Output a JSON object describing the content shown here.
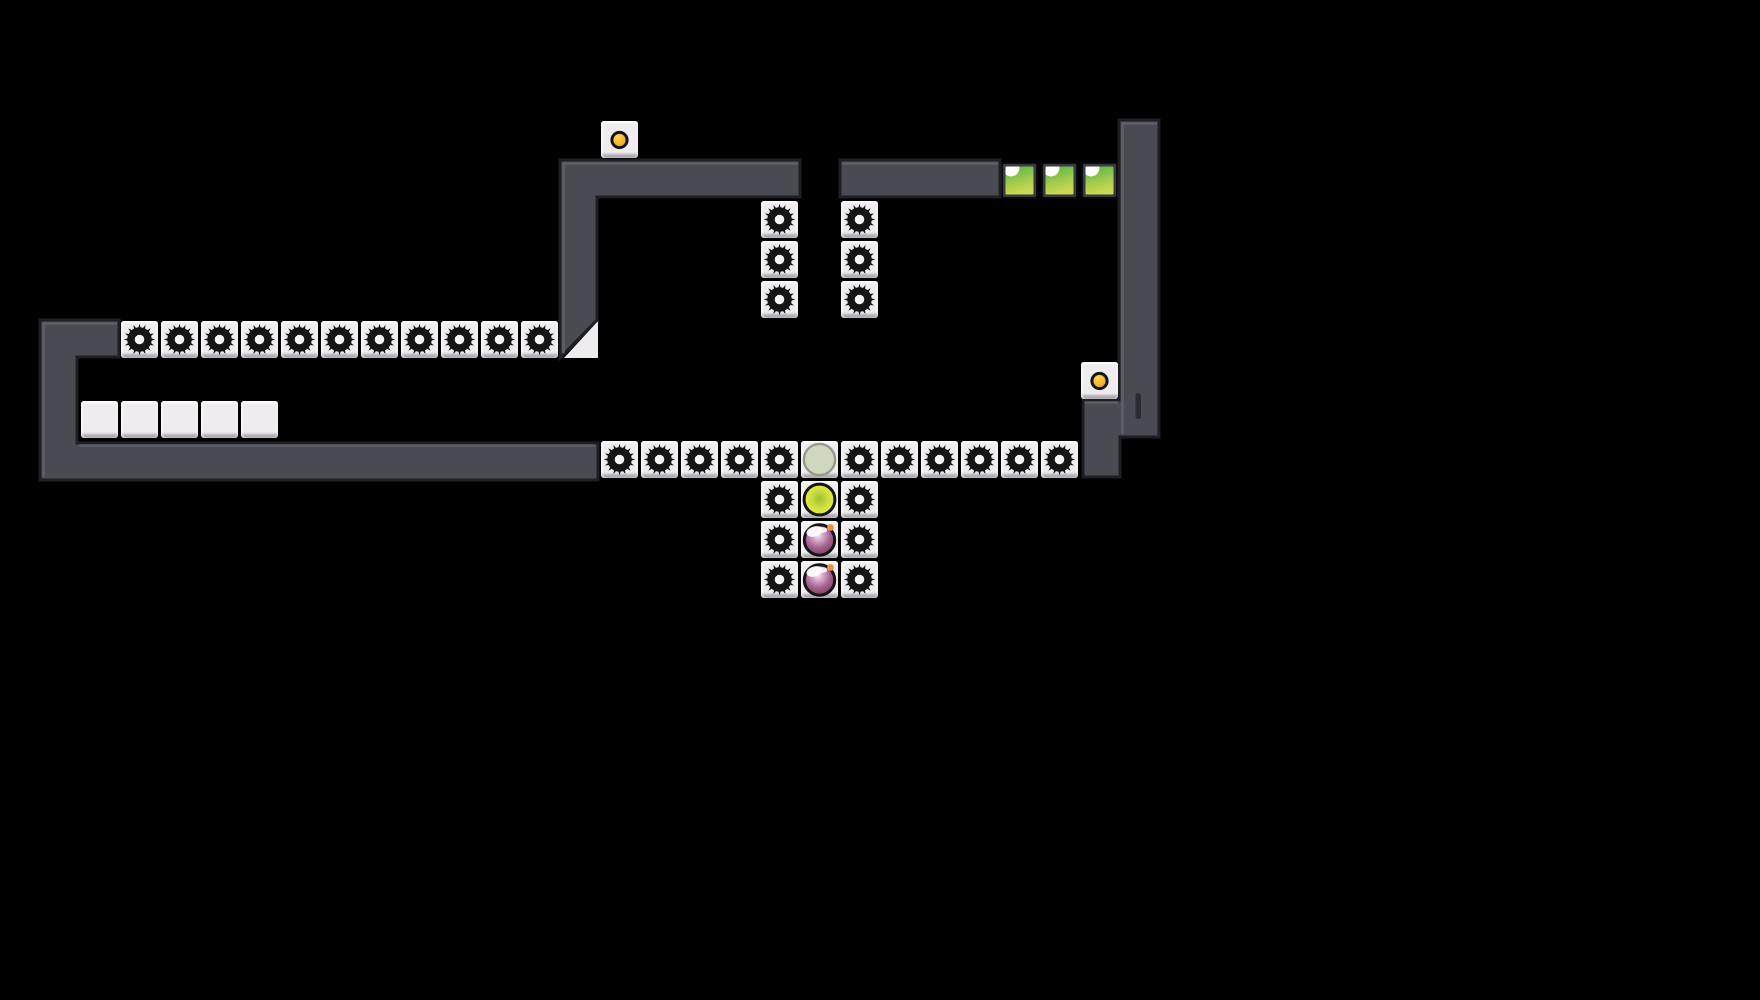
{
  "scene": {
    "width": 1760,
    "height": 1000,
    "background": "#000000"
  },
  "palette": {
    "wall_fill": "#4a4a52",
    "wall_outline": "#1e1e24",
    "wall_highlight": "#5f5f67",
    "tile_face": "#eeecef",
    "gear": "#151515",
    "gear_hole": "#f6f5f7",
    "dot_ring": "#141414",
    "dot_fill_light": "#ffd94f",
    "dot_fill_dark": "#eb9b12",
    "green_frame_outer": "#0e0e10",
    "green_frame_inner": "#3a3a42",
    "green_top": "#55b248",
    "green_mid": "#9cc84d",
    "green_bottom": "#ccd952",
    "green_notch": "#ffffff",
    "marker_fill": "#cfd8bf",
    "marker_ring": "#98988f",
    "ball_outline": "#151515",
    "ball_center": "#9dc13a",
    "ball_mid": "#cfe13d",
    "ball_edge": "#e9f23f",
    "plum_light": "#f2e6f0",
    "plum_pink": "#cf9ec2",
    "plum_mid": "#a4638f",
    "plum_deep": "#8a3f63",
    "plum_dark": "#6f2f4e",
    "plum_stem": "#ef9134",
    "slot_fill": "#2b2b32"
  },
  "grid": {
    "cell": 40,
    "tile": 37
  },
  "icons": {
    "gear": "saw-blade-icon",
    "dot": "pin-dot-icon",
    "marker": "target-circle-icon",
    "yellow_ball": "yellow-ball-icon",
    "plum": "plum-fruit-icon",
    "green": "green-block-icon"
  },
  "walls": [
    {
      "name": "left-c-wall",
      "path": "M40,320 H119 V357 H77 V443 H598 V480 H40 Z"
    },
    {
      "name": "top-left-bar-with-leg",
      "path": "M560,160 H800 V197 H597 V320 L560,358 Z"
    },
    {
      "name": "top-right-bar",
      "path": "M840,160 H1000 V197 H840 Z"
    },
    {
      "name": "right-wall-with-foot",
      "path": "M1119,120 H1159 V437 H1120 V477 H1083 V400 H1119 Z"
    }
  ],
  "wall_highlights": [
    "M43.5,476 V323.5 H116",
    "M80,445.5 H594",
    "M563.5,352 V163.5 H797",
    "M843,163.5 H997",
    "M1122.5,433 V123.5 H1156",
    "M1085.5,402.5 H1117"
  ],
  "underlays": [
    {
      "name": "wedge-tile",
      "path": "M598,321 L598,358 L564,358 Z"
    }
  ],
  "details": [
    {
      "name": "wall-slot-mark",
      "x": 1135.5,
      "y": 393,
      "w": 5.5,
      "h": 26,
      "r": 2.7
    }
  ],
  "tiles": {
    "gear": [
      [
        120,
        320
      ],
      [
        160,
        320
      ],
      [
        200,
        320
      ],
      [
        240,
        320
      ],
      [
        280,
        320
      ],
      [
        320,
        320
      ],
      [
        360,
        320
      ],
      [
        400,
        320
      ],
      [
        440,
        320
      ],
      [
        480,
        320
      ],
      [
        520,
        320
      ],
      [
        760,
        200
      ],
      [
        760,
        240
      ],
      [
        760,
        280
      ],
      [
        840,
        200
      ],
      [
        840,
        240
      ],
      [
        840,
        280
      ],
      [
        600,
        440
      ],
      [
        640,
        440
      ],
      [
        680,
        440
      ],
      [
        720,
        440
      ],
      [
        760,
        440
      ],
      [
        840,
        440
      ],
      [
        880,
        440
      ],
      [
        920,
        440
      ],
      [
        960,
        440
      ],
      [
        1000,
        440
      ],
      [
        1040,
        440
      ],
      [
        760,
        480
      ],
      [
        840,
        480
      ],
      [
        760,
        520
      ],
      [
        840,
        520
      ],
      [
        760,
        560
      ],
      [
        840,
        560
      ]
    ],
    "plain": [
      [
        80,
        400
      ],
      [
        120,
        400
      ],
      [
        160,
        400
      ],
      [
        200,
        400
      ],
      [
        240,
        400
      ]
    ],
    "dot": [
      [
        600,
        120
      ],
      [
        1080,
        361
      ]
    ],
    "green": [
      [
        1000,
        161
      ],
      [
        1040,
        161
      ],
      [
        1080,
        161
      ]
    ],
    "marker": [
      [
        800,
        440
      ]
    ],
    "yellow_ball": [
      [
        800,
        480
      ]
    ],
    "plum": [
      [
        800,
        520
      ],
      [
        800,
        560
      ]
    ]
  }
}
